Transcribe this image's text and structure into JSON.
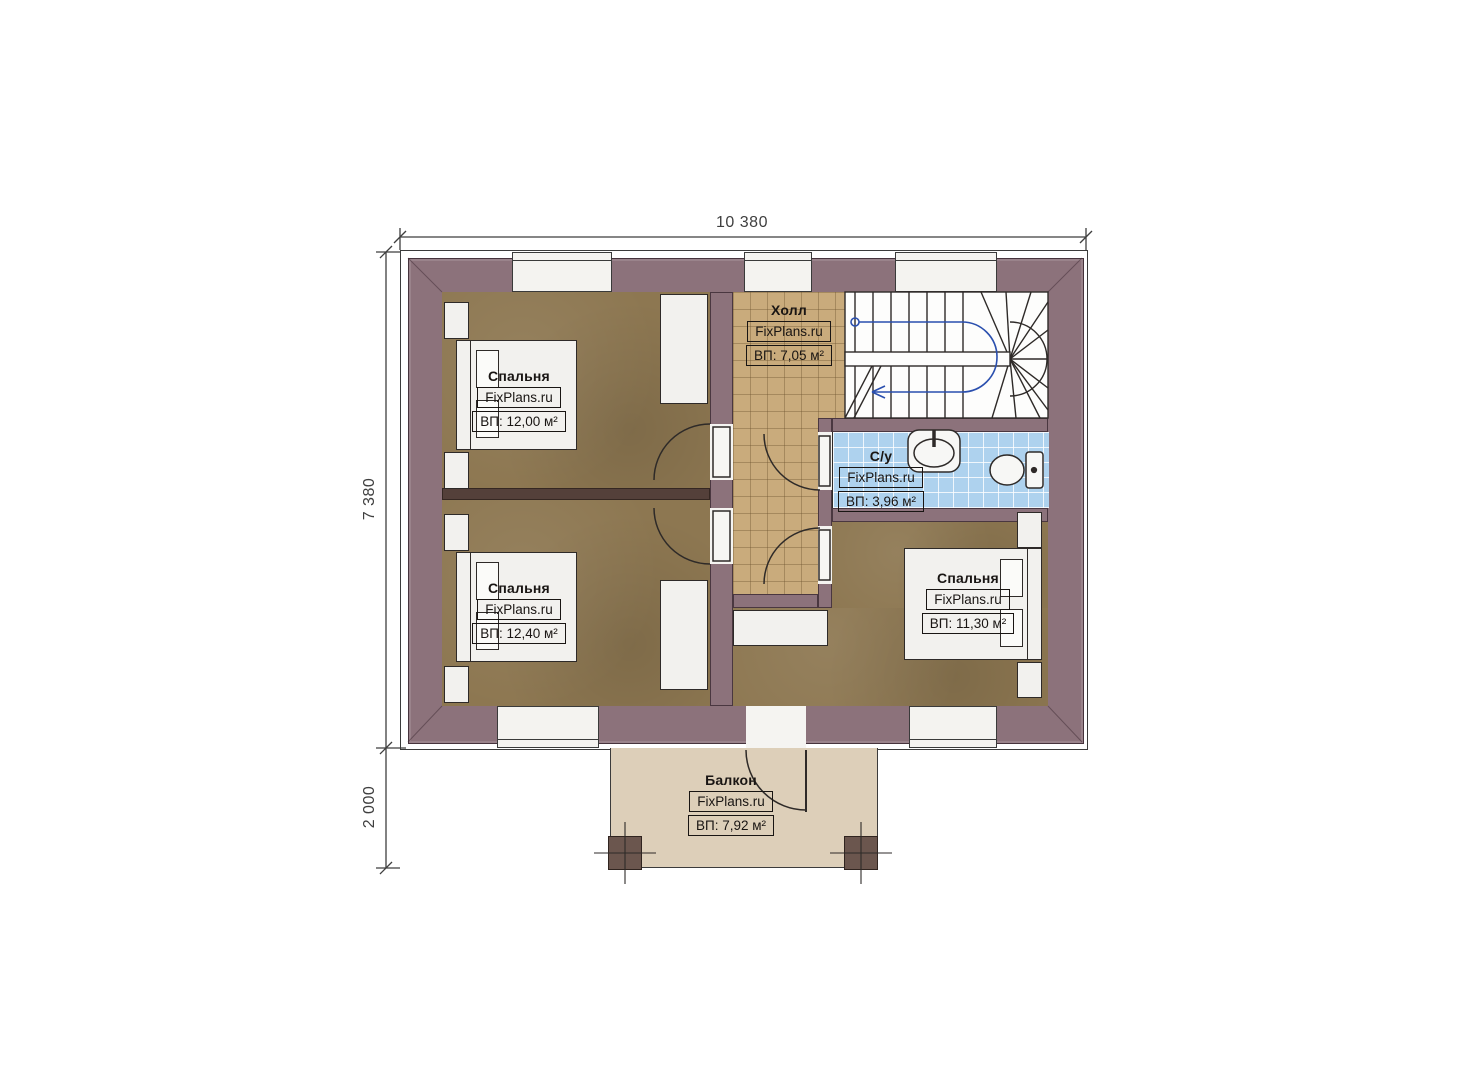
{
  "plan": {
    "type": "floor-plan",
    "floor_note": "second floor plan with balcony and winder staircase"
  },
  "dimensions": {
    "top": "10 380",
    "left_main": "7 380",
    "left_balcony": "2 000"
  },
  "rooms": {
    "bedroom_top_left": {
      "name": "Спальня",
      "brand": "FixPlans.ru",
      "area": "ВП: 12,00 м²"
    },
    "bedroom_bottom_left": {
      "name": "Спальня",
      "brand": "FixPlans.ru",
      "area": "ВП: 12,40 м²"
    },
    "bedroom_right": {
      "name": "Спальня",
      "brand": "FixPlans.ru",
      "area": "ВП: 11,30 м²"
    },
    "hall": {
      "name": "Холл",
      "brand": "FixPlans.ru",
      "area": "ВП: 7,05 м²"
    },
    "bathroom": {
      "name": "С/у",
      "brand": "FixPlans.ru",
      "area": "ВП: 3,96 м²"
    },
    "balcony": {
      "name": "Балкон",
      "brand": "FixPlans.ru",
      "area": "ВП: 7,92 м²"
    }
  },
  "colors": {
    "wall": "#8c727b",
    "wall_dark_partition": "#54403a",
    "bedroom_floor": "#8d7751",
    "hall_floor": "#c9ab7c",
    "bathroom_floor": "#aed2ee",
    "balcony_floor": "#ddcfb9",
    "furniture": "#f2f1ee",
    "line": "#2e2a28",
    "walking_line_start": "#2a4fae"
  }
}
